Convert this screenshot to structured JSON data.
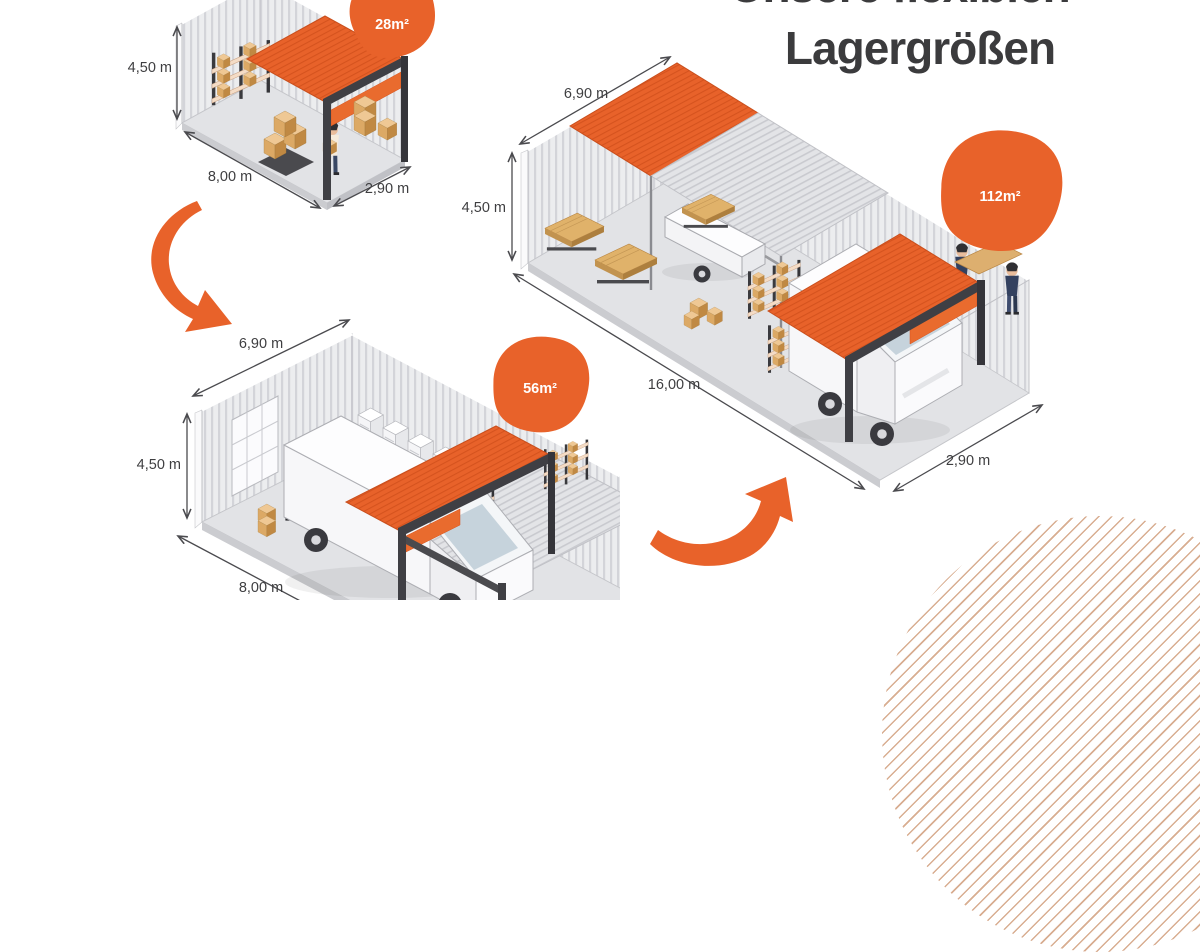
{
  "title": {
    "supertitle_partial": "Unsere flexiblen",
    "main": "Lagergrößen"
  },
  "badges": {
    "small": "28m²",
    "medium": "56m²",
    "large": "112m²"
  },
  "dimensions": {
    "small": {
      "height": "4,50 m",
      "length": "8,00 m",
      "depth": "2,90 m"
    },
    "medium": {
      "top": "6,90 m",
      "height": "4,50 m",
      "length": "8,00 m"
    },
    "large": {
      "top": "6,90 m",
      "height": "4,50 m",
      "length": "16,00 m",
      "depth": "2,90 m"
    }
  },
  "colors": {
    "accent": "#E8622A",
    "heading": "#3B3B3D",
    "dimension_text": "#3E3E40"
  },
  "decorations": {
    "arrow_small_to_medium": "curved-arrow-down",
    "arrow_medium_to_large": "curved-arrow-up",
    "corner_pattern": "striped-circle"
  }
}
